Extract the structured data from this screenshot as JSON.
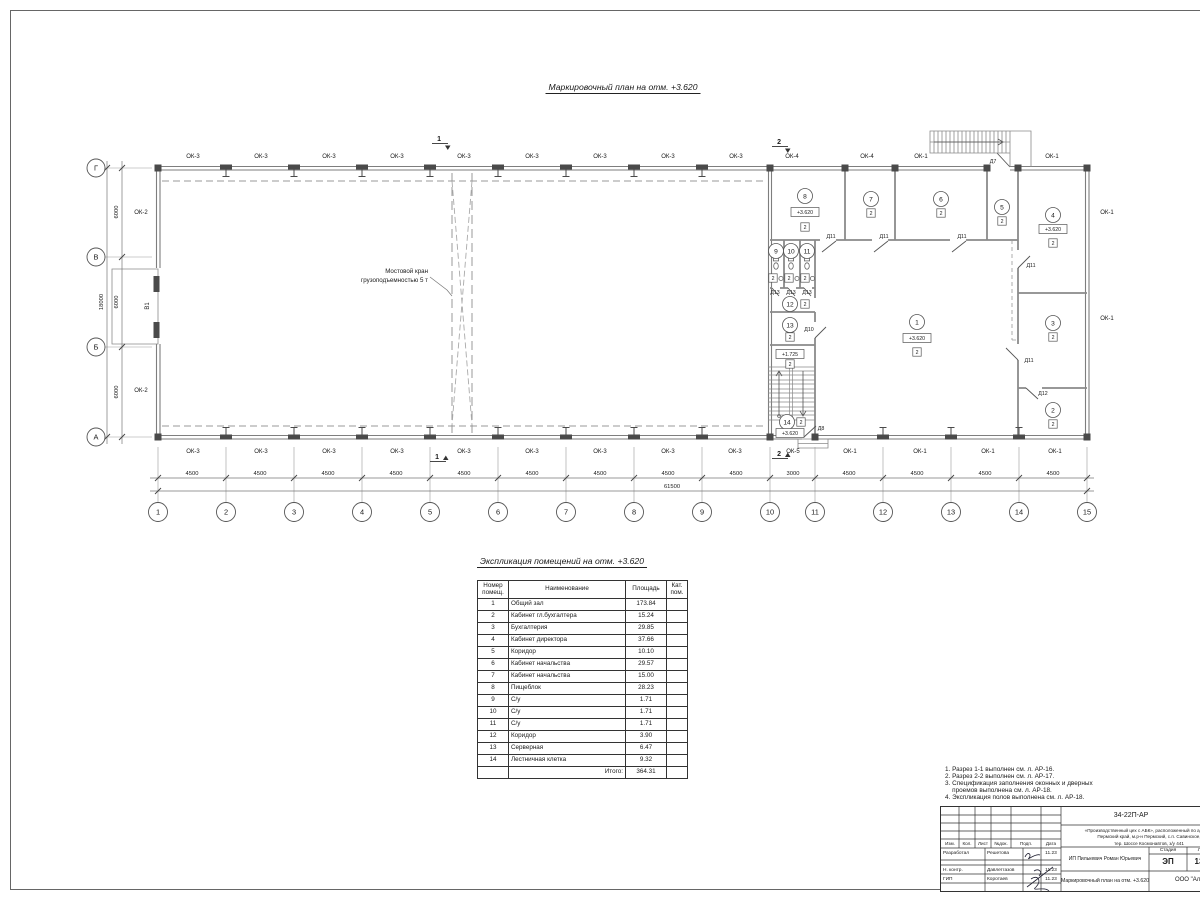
{
  "page": {
    "plan_title": "Маркировочный план  на отм. +3.620",
    "table_title": "Экспликация помещений на отм. +3.620"
  },
  "plan": {
    "crane_line1": "Мостовой кран",
    "crane_line2": "грузоподъемностью 5 т",
    "gate_label": "В1",
    "dim_total_bottom": "61500",
    "dim_total_left": "18000",
    "left_dims": [
      "6000",
      "6000",
      "6000"
    ],
    "window_labels": [
      {
        "t": "ОК-3",
        "x": 193,
        "y": 158
      },
      {
        "t": "ОК-3",
        "x": 261,
        "y": 158
      },
      {
        "t": "ОК-3",
        "x": 329,
        "y": 158
      },
      {
        "t": "ОК-3",
        "x": 397,
        "y": 158
      },
      {
        "t": "ОК-3",
        "x": 464,
        "y": 158
      },
      {
        "t": "ОК-3",
        "x": 532,
        "y": 158
      },
      {
        "t": "ОК-3",
        "x": 600,
        "y": 158
      },
      {
        "t": "ОК-3",
        "x": 668,
        "y": 158
      },
      {
        "t": "ОК-3",
        "x": 736,
        "y": 158
      },
      {
        "t": "ОК-4",
        "x": 792,
        "y": 158
      },
      {
        "t": "ОК-4",
        "x": 867,
        "y": 158
      },
      {
        "t": "ОК-1",
        "x": 921,
        "y": 158
      },
      {
        "t": "ОК-1",
        "x": 1052,
        "y": 158
      },
      {
        "t": "ОК-3",
        "x": 193,
        "y": 453
      },
      {
        "t": "ОК-3",
        "x": 261,
        "y": 453
      },
      {
        "t": "ОК-3",
        "x": 329,
        "y": 453
      },
      {
        "t": "ОК-3",
        "x": 397,
        "y": 453
      },
      {
        "t": "ОК-3",
        "x": 464,
        "y": 453
      },
      {
        "t": "ОК-3",
        "x": 532,
        "y": 453
      },
      {
        "t": "ОК-3",
        "x": 600,
        "y": 453
      },
      {
        "t": "ОК-3",
        "x": 668,
        "y": 453
      },
      {
        "t": "ОК-3",
        "x": 735,
        "y": 453
      },
      {
        "t": "ОК-5",
        "x": 793,
        "y": 453
      },
      {
        "t": "ОК-1",
        "x": 850,
        "y": 453
      },
      {
        "t": "ОК-1",
        "x": 920,
        "y": 453
      },
      {
        "t": "ОК-1",
        "x": 988,
        "y": 453
      },
      {
        "t": "ОК-1",
        "x": 1055,
        "y": 453
      },
      {
        "t": "ОК-2",
        "x": 141,
        "y": 214
      },
      {
        "t": "ОК-2",
        "x": 141,
        "y": 392
      },
      {
        "t": "ОК-1",
        "x": 1107,
        "y": 214
      },
      {
        "t": "ОК-1",
        "x": 1107,
        "y": 320
      }
    ],
    "bottom_dims": [
      {
        "v": "4500",
        "x": 192,
        "y": 475
      },
      {
        "v": "4500",
        "x": 260,
        "y": 475
      },
      {
        "v": "4500",
        "x": 328,
        "y": 475
      },
      {
        "v": "4500",
        "x": 396,
        "y": 475
      },
      {
        "v": "4500",
        "x": 464,
        "y": 475
      },
      {
        "v": "4500",
        "x": 532,
        "y": 475
      },
      {
        "v": "4500",
        "x": 600,
        "y": 475
      },
      {
        "v": "4500",
        "x": 668,
        "y": 475
      },
      {
        "v": "4500",
        "x": 736,
        "y": 475
      },
      {
        "v": "3000",
        "x": 793,
        "y": 475
      },
      {
        "v": "4500",
        "x": 849,
        "y": 475
      },
      {
        "v": "4500",
        "x": 917,
        "y": 475
      },
      {
        "v": "4500",
        "x": 985,
        "y": 475
      },
      {
        "v": "4500",
        "x": 1053,
        "y": 475
      }
    ],
    "col_bubbles": [
      {
        "n": "1",
        "x": 158,
        "y": 512
      },
      {
        "n": "2",
        "x": 226,
        "y": 512
      },
      {
        "n": "3",
        "x": 294,
        "y": 512
      },
      {
        "n": "4",
        "x": 362,
        "y": 512
      },
      {
        "n": "5",
        "x": 430,
        "y": 512
      },
      {
        "n": "6",
        "x": 498,
        "y": 512
      },
      {
        "n": "7",
        "x": 566,
        "y": 512
      },
      {
        "n": "8",
        "x": 634,
        "y": 512
      },
      {
        "n": "9",
        "x": 702,
        "y": 512
      },
      {
        "n": "10",
        "x": 770,
        "y": 512
      },
      {
        "n": "11",
        "x": 815,
        "y": 512
      },
      {
        "n": "12",
        "x": 883,
        "y": 512
      },
      {
        "n": "13",
        "x": 951,
        "y": 512
      },
      {
        "n": "14",
        "x": 1019,
        "y": 512
      },
      {
        "n": "15",
        "x": 1087,
        "y": 512
      }
    ],
    "row_bubbles": [
      {
        "n": "Г",
        "x": 96,
        "y": 168
      },
      {
        "n": "В",
        "x": 96,
        "y": 257
      },
      {
        "n": "Б",
        "x": 96,
        "y": 347
      },
      {
        "n": "А",
        "x": 96,
        "y": 437
      }
    ],
    "rooms": [
      {
        "n": "1",
        "x": 917,
        "y": 322
      },
      {
        "n": "2",
        "x": 1053,
        "y": 410
      },
      {
        "n": "3",
        "x": 1053,
        "y": 323
      },
      {
        "n": "4",
        "x": 1053,
        "y": 215
      },
      {
        "n": "5",
        "x": 1002,
        "y": 207
      },
      {
        "n": "6",
        "x": 941,
        "y": 199
      },
      {
        "n": "7",
        "x": 871,
        "y": 199
      },
      {
        "n": "8",
        "x": 805,
        "y": 196
      },
      {
        "n": "9",
        "x": 776,
        "y": 251
      },
      {
        "n": "10",
        "x": 791,
        "y": 251
      },
      {
        "n": "11",
        "x": 807,
        "y": 251
      },
      {
        "n": "12",
        "x": 790,
        "y": 304
      },
      {
        "n": "13",
        "x": 790,
        "y": 325
      },
      {
        "n": "14",
        "x": 787,
        "y": 422
      }
    ],
    "floor_marks": [
      {
        "v": "2",
        "x": 917,
        "y": 352
      },
      {
        "v": "2",
        "x": 1053,
        "y": 424
      },
      {
        "v": "2",
        "x": 1053,
        "y": 337
      },
      {
        "v": "2",
        "x": 1053,
        "y": 243
      },
      {
        "v": "2",
        "x": 1002,
        "y": 221
      },
      {
        "v": "2",
        "x": 941,
        "y": 213
      },
      {
        "v": "2",
        "x": 871,
        "y": 213
      },
      {
        "v": "2",
        "x": 805,
        "y": 227
      },
      {
        "v": "2",
        "x": 805,
        "y": 304
      },
      {
        "v": "2",
        "x": 790,
        "y": 337
      },
      {
        "v": "2",
        "x": 801,
        "y": 422
      },
      {
        "v": "2",
        "x": 790,
        "y": 364
      },
      {
        "v": "2",
        "x": 773,
        "y": 278
      },
      {
        "v": "2",
        "x": 789,
        "y": 278
      },
      {
        "v": "2",
        "x": 805,
        "y": 278
      }
    ],
    "elevations": [
      {
        "v": "+3.620",
        "x": 917,
        "y": 338
      },
      {
        "v": "+3.620",
        "x": 1053,
        "y": 229
      },
      {
        "v": "+3.620",
        "x": 805,
        "y": 212
      },
      {
        "v": "+1.725",
        "x": 790,
        "y": 354
      },
      {
        "v": "+3.620",
        "x": 790,
        "y": 433
      }
    ],
    "door_labels": [
      {
        "t": "Д11",
        "x": 831,
        "y": 238
      },
      {
        "t": "Д11",
        "x": 884,
        "y": 238
      },
      {
        "t": "Д11",
        "x": 962,
        "y": 238
      },
      {
        "t": "Д11",
        "x": 1031,
        "y": 267
      },
      {
        "t": "Д11",
        "x": 1029,
        "y": 362
      },
      {
        "t": "Д12",
        "x": 1043,
        "y": 395
      },
      {
        "t": "Д13",
        "x": 775,
        "y": 294
      },
      {
        "t": "Д13",
        "x": 791,
        "y": 294
      },
      {
        "t": "Д13",
        "x": 807,
        "y": 294
      },
      {
        "t": "Д10",
        "x": 809,
        "y": 331
      },
      {
        "t": "Д8",
        "x": 821,
        "y": 430
      },
      {
        "t": "Д7",
        "x": 993,
        "y": 163
      }
    ],
    "sections_top": [
      {
        "t": "1",
        "x": 443,
        "y": 141
      },
      {
        "t": "2",
        "x": 783,
        "y": 144
      }
    ],
    "sections_bottom": [
      {
        "t": "1",
        "x": 441,
        "y": 459
      },
      {
        "t": "2",
        "x": 783,
        "y": 456
      }
    ]
  },
  "table": {
    "headers": {
      "num1": "Номер",
      "num2": "помещ.",
      "name": "Наименование",
      "area": "Площадь",
      "cat1": "Кат.",
      "cat2": "пом."
    },
    "rows": [
      {
        "n": "1",
        "name": "Общий зал",
        "area": "173.84"
      },
      {
        "n": "2",
        "name": "Кабинет гл.бухгалтера",
        "area": "15.24"
      },
      {
        "n": "3",
        "name": "Бухгалтерия",
        "area": "29.85"
      },
      {
        "n": "4",
        "name": "Кабинет директора",
        "area": "37.66"
      },
      {
        "n": "5",
        "name": "Коридор",
        "area": "10.10"
      },
      {
        "n": "6",
        "name": "Кабинет начальства",
        "area": "29.57"
      },
      {
        "n": "7",
        "name": "Кабинет начальства",
        "area": "15.00"
      },
      {
        "n": "8",
        "name": "Пищеблок",
        "area": "28.23"
      },
      {
        "n": "9",
        "name": "С/у",
        "area": "1.71"
      },
      {
        "n": "10",
        "name": "С/у",
        "area": "1.71"
      },
      {
        "n": "11",
        "name": "С/у",
        "area": "1.71"
      },
      {
        "n": "12",
        "name": "Коридор",
        "area": "3.90"
      },
      {
        "n": "13",
        "name": "Серверная",
        "area": "6.47"
      },
      {
        "n": "14",
        "name": "Лестничная клетка",
        "area": "9.32"
      }
    ],
    "total_label": "Итого:",
    "total_value": "364.31"
  },
  "notes": [
    "1. Разрез 1-1 выполнен см. л. АР-16.",
    "2. Разрез 2-2 выполнен см. л. АР-17.",
    "3. Спецификация заполнения оконных и дверных",
    "    проемов выполнена см. л. АР-18.",
    "4. Экспликация полов выполнена см. л. АР-18."
  ],
  "titleblock": {
    "doc_code": "34-22П-АР",
    "project_line1": "«Производственный цех с АБК», расположенный по адресу:",
    "project_line2": "Пермский край, м.р-н Пермский, с.п. Савинское,",
    "project_line3": "тер. Шоссе Космонавтов, з/у 441",
    "header_cols": [
      {
        "t": "Изм.",
        "x": 9
      },
      {
        "t": "Кол.",
        "x": 26
      },
      {
        "t": "Лист",
        "x": 42
      },
      {
        "t": "№док.",
        "x": 60
      },
      {
        "t": "Подп.",
        "x": 85
      },
      {
        "t": "Дата",
        "x": 110
      }
    ],
    "sign_rows": [
      {
        "role": "Разработал",
        "name": "Решетова",
        "date": "11.23",
        "y": 44
      },
      {
        "role": "Н. контр.",
        "name": "Давлетгазов",
        "date": "11.23",
        "y": 60.5
      },
      {
        "role": "ГИП",
        "name": "Коротаев",
        "date": "11.23",
        "y": 69.5
      }
    ],
    "client": "ИП Пилькевич Роман Юрьевич",
    "stage_label": "Стадия",
    "sheet_label": "Лист",
    "stage": "ЭП",
    "sheet": "13",
    "drawing_name": "Маркировочный план на отм. +3.620",
    "org": "ООО \"Альянс\""
  }
}
